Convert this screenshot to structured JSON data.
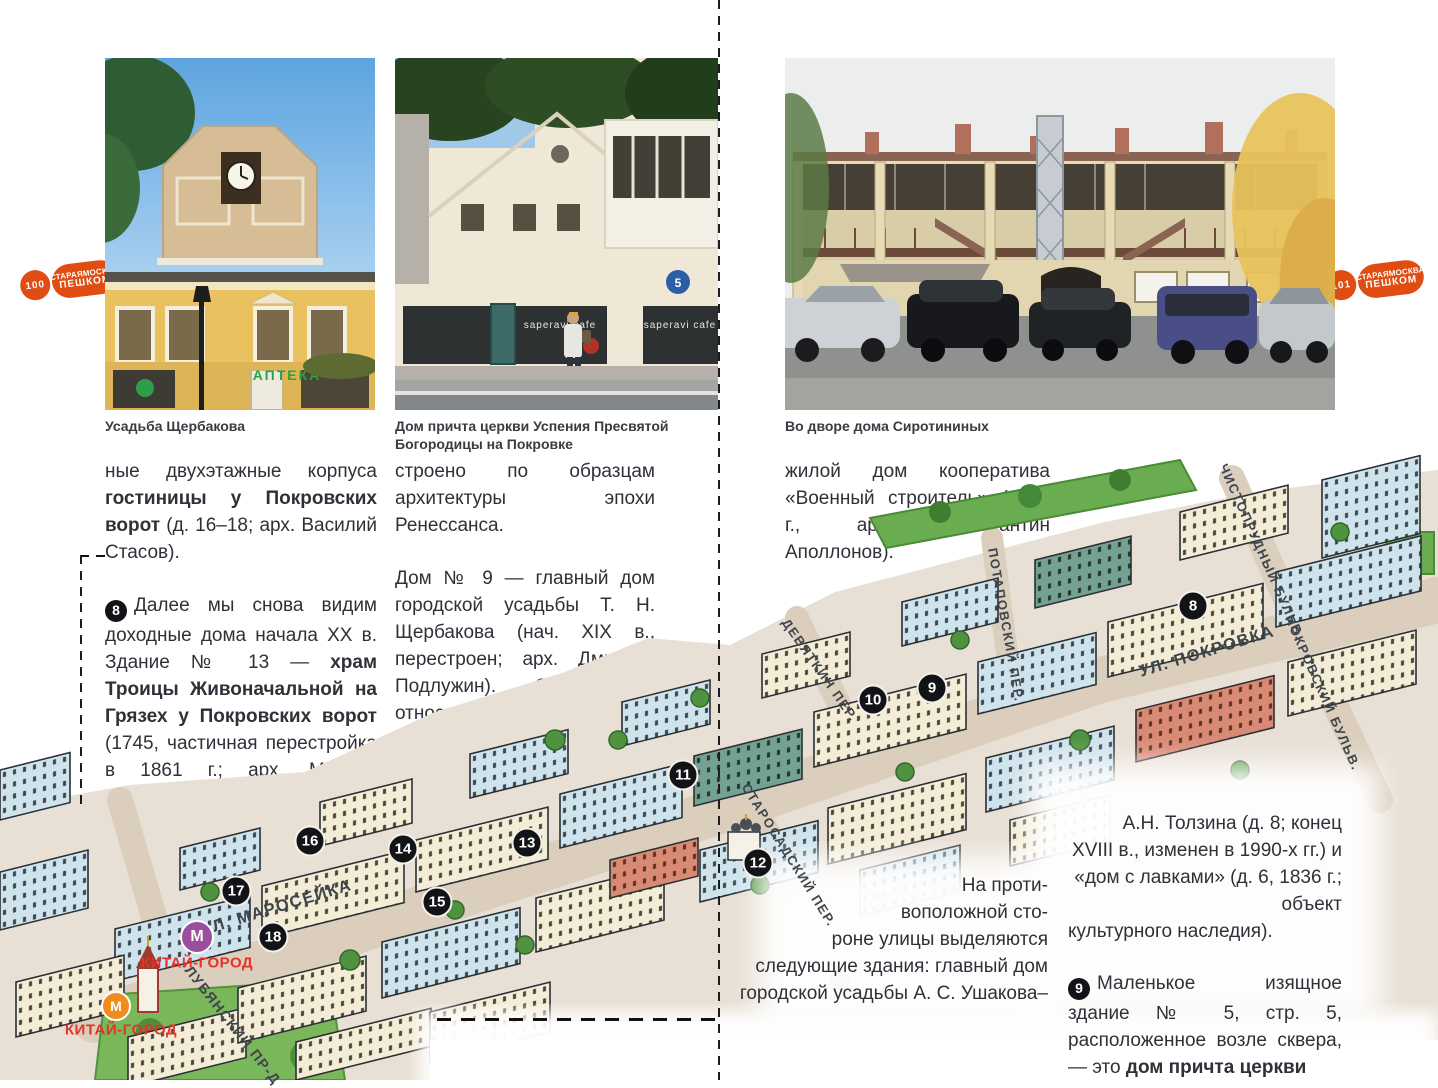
{
  "brand": {
    "left_number": "100",
    "right_number": "101",
    "name_line1": "СТАРАЯМОСКВА",
    "name_line2": "ПЕШКОМ"
  },
  "photos": {
    "caption1": "Усадьба Щербакова",
    "caption2": "Дом причта церкви Успения Пресвятой Богородицы на Покровке",
    "caption3": "Во дворе дома Сиротининых",
    "photo1_sign": "АПТЕКА",
    "photo2_sign_a": "saperavi cafe",
    "photo2_sign_b": "saperavi cafe",
    "photo2_plate": "5"
  },
  "columns": {
    "left": {
      "p1_normal1": "ные двухэтажные корпуса ",
      "p1_bold": "гостиницы у Покровских ворот",
      "p1_normal2": " (д. 16–18; арх. Василий Стасов).",
      "p2_marker": "8",
      "p2_normal1": "Далее мы снова видим доходные дома начала XX в. Здание № 13 — ",
      "p2_bold": "храм Троицы Живоначальной на Грязех у Покровских ворот",
      "p2_normal2": " (1745, частичная перестройка в 1861 г.; арх. Михаил Быковский, памятник архитектуры). Это величественное сооружение по-"
    },
    "middle": {
      "p1": "строено по образцам архитектуры эпохи Ренессанса.",
      "p2": "Дом № 9 — главный дом городской усадьбы Т. Н. Щербакова (нач. XIX в., перестроен; арх. Дмитрий Подлужин). Строгое и относительно высокое здание № 7/9–11 —"
    },
    "right": {
      "p1": "жилой дом кооператива «Военный строитель» (1928 г., арх. Константин Аполлонов)."
    }
  },
  "overlays": {
    "left_block_lines": "На проти-\nвоположной сто-\nроне улицы выделяются\nследующие здания: главный дом\nгородской усадьбы А. С. Ушакова–",
    "right_block_lines": "А.Н. Толзина (д. 8;  конец\nXVIII в., изменен в 1990-х гг.) и\n«дом с лавками» (д. 6, 1836 г.; объект",
    "right_block_last": "культурного наследия).",
    "p9_marker": "9",
    "p9_normal": "Маленькое изящное здание № 5, стр. 5, расположенное возле сквера, — это ",
    "p9_bold": "дом причта церкви"
  },
  "map": {
    "streets": [
      "УЛ. МАРОСЕЙКА",
      "УЛ. ПОКРОВКА",
      "ДЕВЯТКИН ПЕР.",
      "ПОТАПОВСКИЙ ПЕР.",
      "СТАРОСАДСКИЙ ПЕР.",
      "ЛУБЯНСКИЙ ПР-Д",
      "ЧИСТОПРУДНЫЙ БУЛЬВ.",
      "ПОКРОВСКИЙ БУЛЬВ."
    ],
    "markers": [
      "8",
      "9",
      "10",
      "11",
      "12",
      "13",
      "14",
      "15",
      "16",
      "17",
      "18"
    ],
    "metro_letter": "М",
    "metro_station_1": "КИТАЙ-ГОРОД",
    "metro_station_2": "КИТАЙ-ГОРОД",
    "colors": {
      "metro_purple": "#9a4f9e",
      "metro_orange": "#f08b1e",
      "station_red": "#e63228",
      "marker_black": "#121317",
      "badge_orange": "#e04d12",
      "map_beige": "#e8e0d5"
    }
  }
}
